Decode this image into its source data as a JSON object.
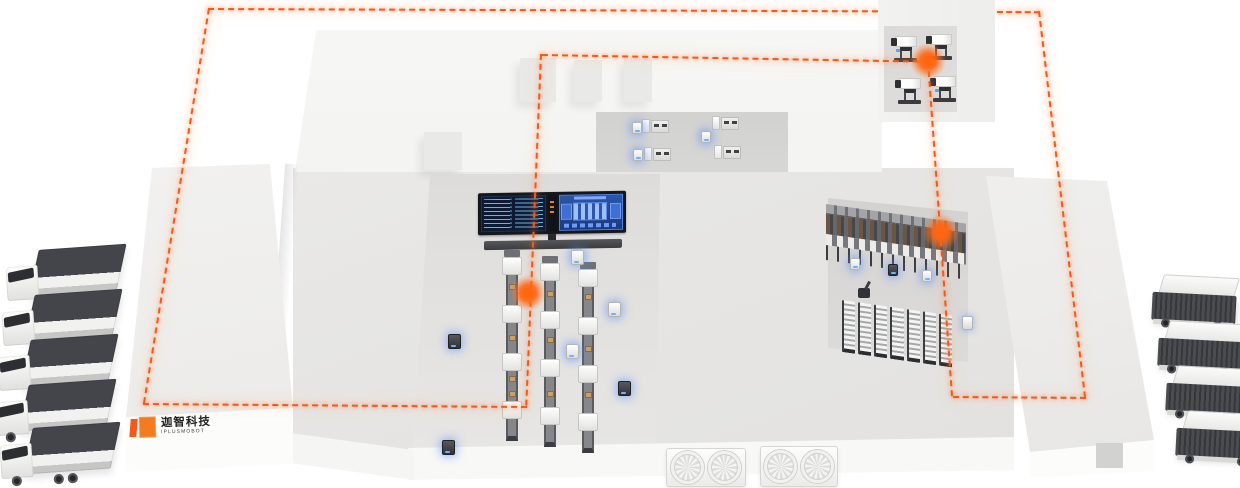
{
  "logo": {
    "company_cn": "迦智科技",
    "company_en": "IPLUSMOBOT"
  },
  "palette": {
    "route_orange": "#f4581d",
    "marker_glow_orange": "#ff660f",
    "agv_glow_blue": "#5a8cff",
    "building_white": "#f6f6f4",
    "floor_gray": "#dedddb",
    "equipment_dark": "#3c3e42",
    "screen_navy": "#0c1a33",
    "screen_panel_blue": "#2d55a8",
    "truck_cargo_dark": "#43454a",
    "conveyor_item_tan": "#c9a06a"
  },
  "scene": {
    "route_style": "dashed-loop",
    "route_marker_count": 3,
    "left_truck_count": 5,
    "right_trailer_count": 4,
    "assembly_line_count": 3,
    "agv_count": 12,
    "dock_fan_count": 4,
    "top_right_machine_count": 4,
    "top_middle_machine_count": 4,
    "rack_module_count": 7
  }
}
